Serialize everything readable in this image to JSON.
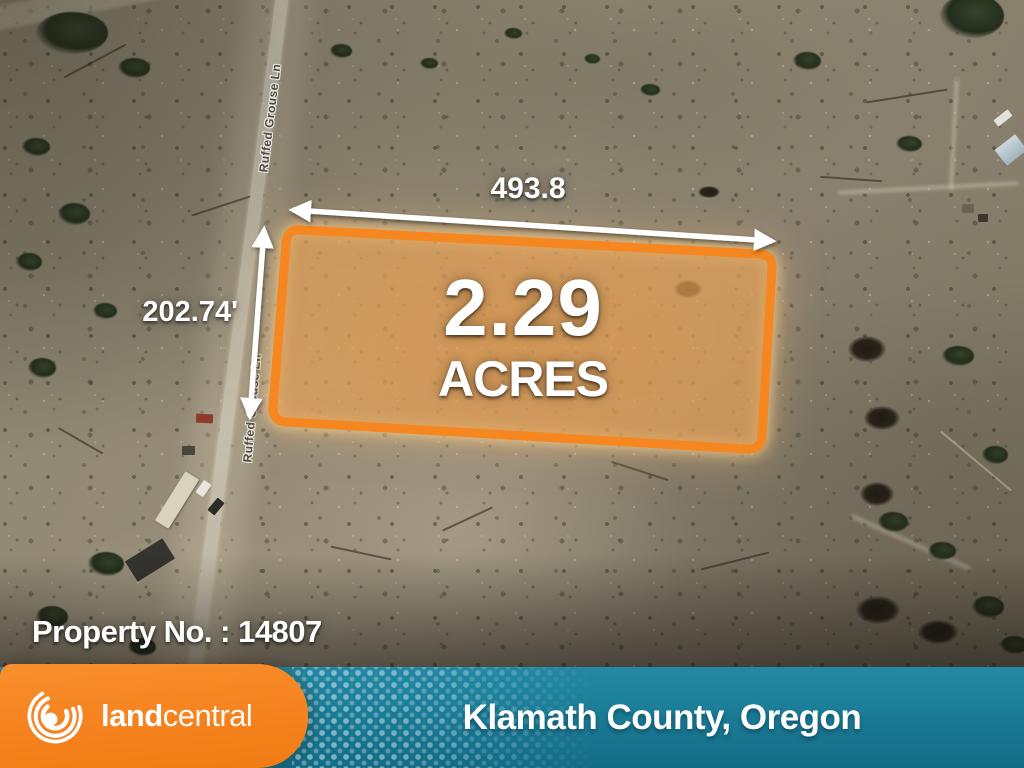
{
  "map": {
    "road_name": "Ruffed Grouse Ln",
    "property_number_label": "Property No. : 14807",
    "property": {
      "area_value": "2.29",
      "area_unit": "ACRES",
      "width_label": "493.8",
      "depth_label": "202.74'"
    }
  },
  "footer": {
    "brand_bold": "land",
    "brand_light": "central",
    "location": "Klamath County, Oregon"
  },
  "colors": {
    "brand_orange": "#F5821F",
    "banner_teal": "#1C7D98",
    "boundary_orange": "#F6861F",
    "annotation_white": "#FFFFFF"
  }
}
